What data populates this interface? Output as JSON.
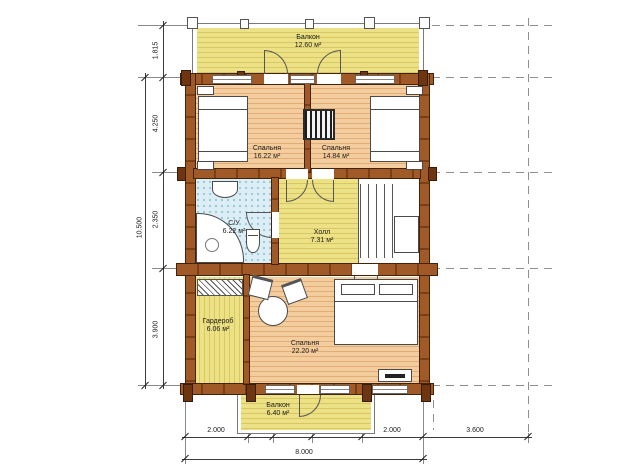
{
  "plan": {
    "type": "floor-plan",
    "language": "ru"
  },
  "rooms": {
    "balcony_top": {
      "name": "Балкон",
      "area": "12.60 м²"
    },
    "bedroom_left": {
      "name": "Спальня",
      "area": "16.22 м²"
    },
    "bedroom_right": {
      "name": "Спальня",
      "area": "14.84 м²"
    },
    "bathroom": {
      "name": "С/У",
      "area": "6.22 м²"
    },
    "hall": {
      "name": "Холл",
      "area": "7.31 м²"
    },
    "wardrobe": {
      "name": "Гардероб",
      "area": "6.06 м²"
    },
    "bedroom_big": {
      "name": "Спальня",
      "area": "22.20 м²"
    },
    "balcony_bottom": {
      "name": "Балкон",
      "area": "6.40 м²"
    }
  },
  "dims": {
    "left": [
      "1.815",
      "4.250",
      "2.350",
      "3.900"
    ],
    "left_total": "10.500",
    "bottom": [
      "2.000",
      "975",
      "1.225",
      "1.800",
      "2.000",
      "3.600"
    ],
    "bottom_total": "8.000"
  },
  "furniture": [
    "bed",
    "bed",
    "double-bed",
    "bathtub-corner",
    "sink",
    "toilet",
    "stairs",
    "chimney",
    "hanger-rack",
    "round-table",
    "chair",
    "chair",
    "dresser"
  ],
  "palette": {
    "wall": "#96511f",
    "wall_dark": "#44220a",
    "floor_yellow": "#ece184",
    "floor_peach": "#f4cd9e",
    "tile_blue": "#dbeef5",
    "line": "#4a4a4a",
    "dim": "#1a1a1a"
  }
}
